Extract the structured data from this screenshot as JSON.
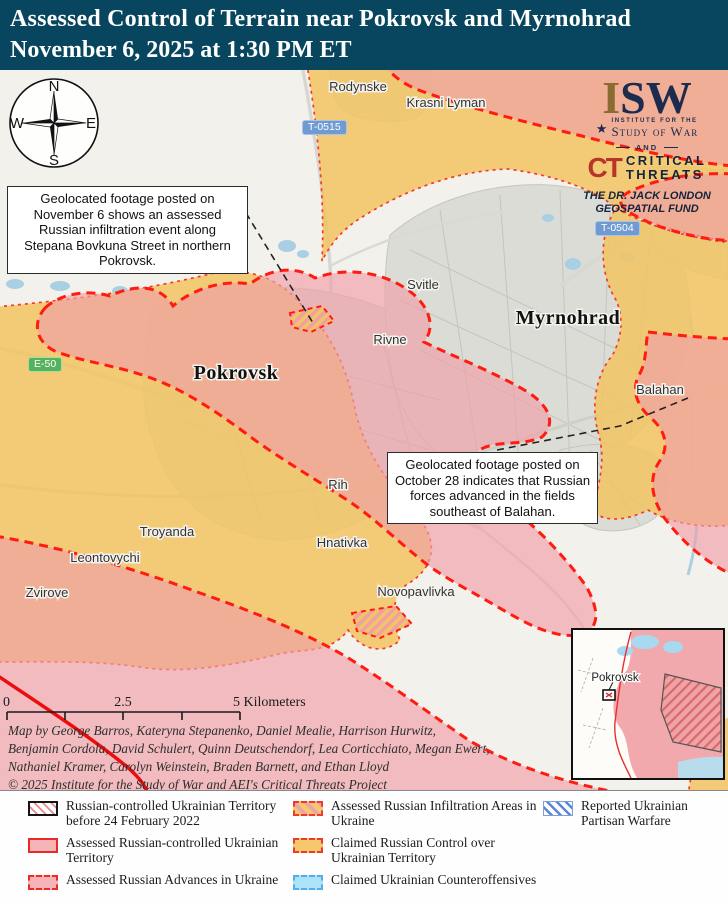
{
  "header": {
    "title_line1": "Assessed Control of Terrain near Pokrovsk and Myrnohrad",
    "title_line2": "November 6, 2025 at 1:30 PM ET"
  },
  "logos": {
    "isw_i": "I",
    "isw_sw": "SW",
    "star": "★",
    "institute_line1": "INSTITUTE FOR THE",
    "institute_line2": "Study of War",
    "and": "AND",
    "ct": "CT",
    "ct_line1": "CRITICAL",
    "ct_line2": "THREATS",
    "fund_line1": "THE DR. JACK LONDON",
    "fund_line2": "GEOSPATIAL FUND"
  },
  "compass": {
    "n": "N",
    "e": "E",
    "s": "S",
    "w": "W"
  },
  "callouts": {
    "november": "Geolocated footage posted on November 6 shows an assessed Russian infiltration event along Stepana Bovkuna Street in northern Pokrovsk.",
    "october": "Geolocated footage posted on October 28 indicates that Russian forces advanced in the fields southeast of Balahan."
  },
  "road_shields": {
    "t0515": "T-0515",
    "t0504": "T-0504",
    "e50": "E-50"
  },
  "places": {
    "rodynske": "Rodynske",
    "krasni_lyman": "Krasni Lyman",
    "svitle": "Svitle",
    "rivne": "Rivne",
    "myrnohrad": "Myrnohrad",
    "pokrovsk": "Pokrovsk",
    "balahan": "Balahan",
    "rih": "Rih",
    "hnativka": "Hnativka",
    "troyanda": "Troyanda",
    "leontovychi": "Leontovychi",
    "zvirove": "Zvirove",
    "novopavlivka": "Novopavlivka"
  },
  "inset": {
    "label": "Pokrovsk"
  },
  "scalebar": {
    "start": "0",
    "mid": "2.5",
    "end": "5 Kilometers"
  },
  "credits": {
    "line1": "Map by George Barros, Kateryna Stepanenko, Daniel Mealie, Harrison Hurwitz,",
    "line2": "Benjamin Cordola, David Schulert, Quinn Deutschendorf, Lea Corticchiato, Megan Ewert,",
    "line3": "Nathaniel Kramer, Carolyn Weinstein, Braden Barnett, and Ethan Lloyd",
    "line4": "© 2025 Institute for the Study of War and AEI's Critical Threats Project"
  },
  "legend": {
    "item1": "Russian-controlled Ukrainian Territory before 24 February 2022",
    "item2": "Assessed Russian-controlled Ukrainian Territory",
    "item3": "Assessed Russian Advances in Ukraine",
    "item4": "Assessed Russian Infiltration Areas in Ukraine",
    "item5": "Claimed Russian Control over Ukrainian Territory",
    "item6": "Claimed Ukrainian Counteroffensives",
    "item7": "Reported Ukrainian Partisan Warfare"
  },
  "colors": {
    "header_bg": "#07465e",
    "claimed_orange": "#f2c461",
    "advance_pink": "#f0a0a7",
    "advance_border_red": "#ff1b10",
    "claimed_border_red": "#f23b2a",
    "solid_front_red": "#ee0d0d",
    "road_shield_blue": "#6f9bd2",
    "road_shield_green": "#57b25e",
    "counteroffensive_blue": "#ace3f8",
    "partisan_blue": "#5b86d6"
  }
}
